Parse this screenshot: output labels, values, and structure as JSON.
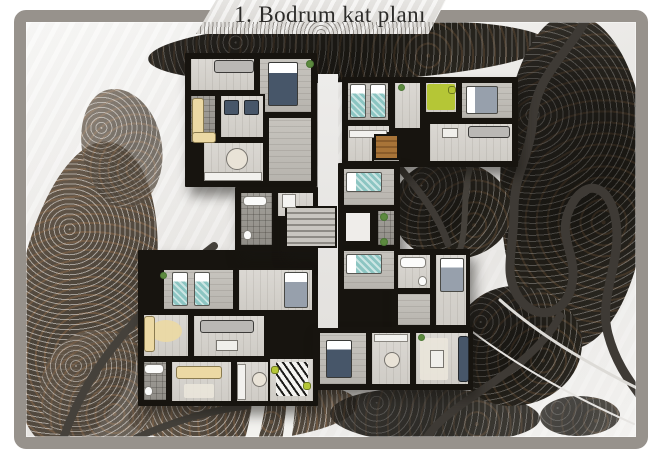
{
  "title": {
    "text": "1. Bodrum kat planı"
  },
  "palette": {
    "frame": "#97928c",
    "wall": "#17140f",
    "floor": "#dbd8d3",
    "floorMid": "#c7c4be",
    "balcony": "#a3a09a",
    "teal": "#8cc5c2",
    "navy": "#475669",
    "cream": "#ecd9a4",
    "lime": "#b5c636",
    "wood": "#8a5c2a",
    "treeDark": "#232019",
    "treeBrown": "#4a4238",
    "road": "#3e3a35",
    "snowPath": "#f3f2ef"
  },
  "scene": {
    "trees": [
      {
        "v": "t-dark",
        "x": 148,
        "y": 20,
        "w": 400,
        "h": 62,
        "r": -2
      },
      {
        "v": "t-dark",
        "x": 500,
        "y": 14,
        "w": 148,
        "h": 336,
        "r": 0
      },
      {
        "v": "t-dark",
        "x": 392,
        "y": 160,
        "w": 120,
        "h": 100,
        "r": 8
      },
      {
        "v": "t-brown",
        "x": 18,
        "y": 140,
        "w": 135,
        "h": 310,
        "r": 10
      },
      {
        "v": "t-brown",
        "x": 82,
        "y": 88,
        "w": 80,
        "h": 120,
        "r": -12,
        "o": 0.75
      },
      {
        "v": "t-brown",
        "x": 128,
        "y": 380,
        "w": 230,
        "h": 62,
        "r": -3
      },
      {
        "v": "t-dark",
        "x": 330,
        "y": 388,
        "w": 210,
        "h": 56,
        "r": 2,
        "o": 0.9
      },
      {
        "v": "t-dark",
        "x": 452,
        "y": 286,
        "w": 130,
        "h": 120,
        "r": 0
      },
      {
        "v": "t-brown",
        "x": 40,
        "y": 330,
        "w": 120,
        "h": 120,
        "r": 0,
        "o": 0.85
      },
      {
        "v": "t-dark",
        "x": 540,
        "y": 396,
        "w": 80,
        "h": 40,
        "r": 0,
        "o": 0.8
      }
    ],
    "roads": [
      {
        "n": "mountain-road",
        "d": "M588,16 C568,54 536,76 533,118 C530,158 514,172 514,210 C514,252 502,272 519,298 C536,322 566,316 572,284 C578,254 556,238 570,208 C584,178 610,182 616,222 C622,262 598,296 608,334 C618,372 638,390 650,410",
        "c": "#3e3a35",
        "w": 9
      },
      {
        "n": "road-branch",
        "d": "M560,316 C538,356 498,378 468,400 C448,414 430,428 422,446",
        "c": "#3e3a35",
        "w": 8
      },
      {
        "n": "road-notch-1",
        "d": "M400,168 C420,192 438,214 448,244",
        "c": "#3e3a35",
        "w": 7
      },
      {
        "n": "road-notch-2",
        "d": "M470,168 C462,198 468,222 460,250",
        "c": "#45413b",
        "w": 6
      },
      {
        "n": "road-left",
        "d": "M214,246 C172,278 122,332 98,368 C82,392 72,414 64,436",
        "c": "#45413b",
        "w": 8
      },
      {
        "n": "road-bottom-left",
        "d": "M136,438 C176,420 214,410 246,406",
        "c": "#45413b",
        "w": 7
      },
      {
        "n": "footpath-1",
        "d": "M259,402 C257,418 254,430 250,446",
        "c": "#f3f2ef",
        "w": 13
      },
      {
        "n": "footpath-2",
        "d": "M291,402 C290,418 288,432 286,446",
        "c": "#f3f2ef",
        "w": 9
      },
      {
        "n": "snow-streak-1",
        "d": "M500,300 C545,340 600,370 645,392",
        "c": "#dddbd7",
        "w": 3
      },
      {
        "n": "snow-streak-2",
        "d": "M470,330 C520,368 580,400 634,424",
        "c": "#e6e4e1",
        "w": 2
      }
    ]
  },
  "plan": {
    "blocks": [
      {
        "x": 185,
        "y": 53,
        "w": 132,
        "h": 134,
        "n": "wing-top-left"
      },
      {
        "x": 342,
        "y": 77,
        "w": 176,
        "h": 90,
        "n": "wing-top-right"
      },
      {
        "x": 338,
        "y": 163,
        "w": 62,
        "h": 166,
        "n": "core-right"
      },
      {
        "x": 392,
        "y": 249,
        "w": 78,
        "h": 82,
        "n": "wing-mid-right"
      },
      {
        "x": 138,
        "y": 250,
        "w": 180,
        "h": 156,
        "n": "wing-bottom-left"
      },
      {
        "x": 313,
        "y": 327,
        "w": 160,
        "h": 63,
        "n": "wing-bottom-right"
      },
      {
        "x": 235,
        "y": 187,
        "w": 83,
        "h": 64,
        "n": "wing-mid-left"
      },
      {
        "x": 281,
        "y": 202,
        "w": 60,
        "h": 50,
        "n": "stair-core"
      }
    ],
    "rooms": [
      {
        "x": 318,
        "y": 74,
        "w": 20,
        "h": 254,
        "f": "snow",
        "n": "light-well"
      },
      {
        "x": 189,
        "y": 57,
        "w": 67,
        "h": 35,
        "f": "light",
        "n": "bedroom"
      },
      {
        "x": 258,
        "y": 57,
        "w": 55,
        "h": 57,
        "f": "mid",
        "n": "bedroom"
      },
      {
        "x": 189,
        "y": 94,
        "w": 28,
        "h": 50,
        "f": "balcony",
        "n": "balcony"
      },
      {
        "x": 219,
        "y": 94,
        "w": 46,
        "h": 45,
        "f": "light",
        "n": "living-room"
      },
      {
        "x": 202,
        "y": 141,
        "w": 63,
        "h": 42,
        "f": "light",
        "n": "kitchen"
      },
      {
        "x": 267,
        "y": 116,
        "w": 46,
        "h": 67,
        "f": "mid",
        "n": "hall"
      },
      {
        "x": 346,
        "y": 81,
        "w": 44,
        "h": 41,
        "f": "mid",
        "n": "bedroom"
      },
      {
        "x": 346,
        "y": 124,
        "w": 45,
        "h": 39,
        "f": "light",
        "n": "study"
      },
      {
        "x": 393,
        "y": 81,
        "w": 29,
        "h": 49,
        "f": "light",
        "n": "hall"
      },
      {
        "x": 424,
        "y": 81,
        "w": 34,
        "h": 33,
        "f": "light",
        "n": "office"
      },
      {
        "x": 460,
        "y": 81,
        "w": 54,
        "h": 39,
        "f": "mid",
        "n": "bedroom"
      },
      {
        "x": 428,
        "y": 122,
        "w": 86,
        "h": 41,
        "f": "light",
        "n": "living-room"
      },
      {
        "x": 372,
        "y": 132,
        "w": 29,
        "h": 31,
        "f": "mid",
        "n": "stair-hall"
      },
      {
        "x": 342,
        "y": 167,
        "w": 54,
        "h": 40,
        "f": "mid",
        "n": "bedroom"
      },
      {
        "x": 342,
        "y": 209,
        "w": 32,
        "h": 36,
        "f": "light",
        "n": "elevator-lobby"
      },
      {
        "x": 376,
        "y": 209,
        "w": 20,
        "h": 38,
        "f": "balcony",
        "n": "lobby"
      },
      {
        "x": 342,
        "y": 249,
        "w": 54,
        "h": 42,
        "f": "mid",
        "n": "bedroom"
      },
      {
        "x": 396,
        "y": 253,
        "w": 36,
        "h": 37,
        "f": "light",
        "n": "bathroom"
      },
      {
        "x": 434,
        "y": 253,
        "w": 34,
        "h": 74,
        "f": "light",
        "n": "bedroom"
      },
      {
        "x": 396,
        "y": 292,
        "w": 36,
        "h": 35,
        "f": "mid",
        "n": "hall"
      },
      {
        "x": 239,
        "y": 191,
        "w": 35,
        "h": 56,
        "f": "balcony",
        "n": "bathroom"
      },
      {
        "x": 276,
        "y": 191,
        "w": 39,
        "h": 27,
        "f": "light",
        "n": "bathroom"
      },
      {
        "x": 162,
        "y": 268,
        "w": 73,
        "h": 43,
        "f": "mid",
        "n": "bedroom"
      },
      {
        "x": 237,
        "y": 268,
        "w": 77,
        "h": 44,
        "f": "light",
        "n": "bedroom"
      },
      {
        "x": 142,
        "y": 313,
        "w": 48,
        "h": 45,
        "f": "light",
        "n": "balcony"
      },
      {
        "x": 192,
        "y": 314,
        "w": 74,
        "h": 44,
        "f": "light",
        "n": "living-room"
      },
      {
        "x": 142,
        "y": 360,
        "w": 26,
        "h": 42,
        "f": "balcony",
        "n": "bathroom"
      },
      {
        "x": 170,
        "y": 360,
        "w": 63,
        "h": 43,
        "f": "light",
        "n": "living-room"
      },
      {
        "x": 235,
        "y": 360,
        "w": 42,
        "h": 43,
        "f": "light",
        "n": "kitchen"
      },
      {
        "x": 268,
        "y": 357,
        "w": 47,
        "h": 46,
        "f": "light",
        "n": "kids-room"
      },
      {
        "x": 318,
        "y": 331,
        "w": 50,
        "h": 55,
        "f": "mid",
        "n": "bedroom"
      },
      {
        "x": 370,
        "y": 331,
        "w": 42,
        "h": 55,
        "f": "light",
        "n": "kitchen"
      },
      {
        "x": 414,
        "y": 331,
        "w": 56,
        "h": 55,
        "f": "light",
        "n": "living-room"
      }
    ],
    "items": [
      {
        "t": "sofa-light",
        "x": 214,
        "y": 60,
        "w": 40,
        "h": 13,
        "n": "sofa"
      },
      {
        "t": "bed-navy",
        "x": 268,
        "y": 62,
        "w": 30,
        "h": 44,
        "n": "bed"
      },
      {
        "t": "armchair-navy",
        "x": 224,
        "y": 100,
        "w": 15,
        "h": 15,
        "n": "armchair"
      },
      {
        "t": "armchair-navy",
        "x": 244,
        "y": 100,
        "w": 15,
        "h": 15,
        "n": "armchair"
      },
      {
        "t": "sofa-cream",
        "x": 192,
        "y": 98,
        "w": 12,
        "h": 40,
        "n": "balcony-sofa"
      },
      {
        "t": "sofa-cream",
        "x": 192,
        "y": 132,
        "w": 24,
        "h": 11,
        "n": "balcony-sofa"
      },
      {
        "t": "table-round",
        "x": 226,
        "y": 148,
        "w": 22,
        "h": 22,
        "n": "dining-table"
      },
      {
        "t": "counter",
        "x": 204,
        "y": 172,
        "w": 58,
        "h": 9,
        "n": "kitchen-counter"
      },
      {
        "t": "plant",
        "x": 306,
        "y": 60,
        "w": 8,
        "h": 8,
        "n": "plant"
      },
      {
        "t": "bed-teal",
        "o": "v",
        "x": 350,
        "y": 84,
        "w": 16,
        "h": 34,
        "n": "bed"
      },
      {
        "t": "bed-teal",
        "o": "v",
        "x": 370,
        "y": 84,
        "w": 16,
        "h": 34,
        "n": "bed"
      },
      {
        "t": "counter",
        "x": 349,
        "y": 130,
        "w": 38,
        "h": 8,
        "n": "desk"
      },
      {
        "t": "rug-green",
        "x": 427,
        "y": 84,
        "w": 28,
        "h": 26,
        "n": "rug"
      },
      {
        "t": "chair-green",
        "x": 448,
        "y": 86,
        "w": 8,
        "h": 8,
        "n": "chair"
      },
      {
        "t": "bed-gray",
        "x": 466,
        "y": 86,
        "w": 32,
        "h": 28,
        "n": "bed"
      },
      {
        "t": "sofa-light",
        "x": 468,
        "y": 126,
        "w": 42,
        "h": 12,
        "n": "sofa"
      },
      {
        "t": "table",
        "x": 442,
        "y": 128,
        "w": 16,
        "h": 10,
        "n": "coffee-table"
      },
      {
        "t": "stair-wood",
        "x": 374,
        "y": 134,
        "w": 25,
        "h": 26,
        "n": "staircase"
      },
      {
        "t": "plant",
        "x": 398,
        "y": 84,
        "w": 7,
        "h": 7,
        "n": "plant"
      },
      {
        "t": "bed-teal",
        "x": 346,
        "y": 172,
        "w": 36,
        "h": 20,
        "n": "bed"
      },
      {
        "t": "elevator",
        "x": 344,
        "y": 211,
        "w": 28,
        "h": 32,
        "n": "elevator"
      },
      {
        "t": "plant",
        "x": 380,
        "y": 213,
        "w": 8,
        "h": 8,
        "n": "plant"
      },
      {
        "t": "plant",
        "x": 380,
        "y": 238,
        "w": 8,
        "h": 8,
        "n": "plant"
      },
      {
        "t": "bed-teal",
        "x": 346,
        "y": 254,
        "w": 36,
        "h": 20,
        "n": "bed"
      },
      {
        "t": "tub",
        "x": 400,
        "y": 257,
        "w": 26,
        "h": 11,
        "n": "bathtub"
      },
      {
        "t": "wc",
        "x": 418,
        "y": 276,
        "w": 9,
        "h": 10,
        "n": "toilet"
      },
      {
        "t": "bed-gray",
        "o": "v",
        "x": 440,
        "y": 258,
        "w": 24,
        "h": 34,
        "n": "bed"
      },
      {
        "t": "stair-gray",
        "x": 285,
        "y": 206,
        "w": 52,
        "h": 42,
        "n": "main-staircase"
      },
      {
        "t": "tub",
        "x": 243,
        "y": 196,
        "w": 24,
        "h": 10,
        "n": "bathtub"
      },
      {
        "t": "wc",
        "x": 243,
        "y": 230,
        "w": 9,
        "h": 10,
        "n": "toilet"
      },
      {
        "t": "shower",
        "x": 282,
        "y": 194,
        "w": 14,
        "h": 14,
        "n": "shower"
      },
      {
        "t": "bed-teal",
        "o": "v",
        "x": 172,
        "y": 272,
        "w": 16,
        "h": 34,
        "n": "bed"
      },
      {
        "t": "bed-teal",
        "o": "v",
        "x": 194,
        "y": 272,
        "w": 16,
        "h": 34,
        "n": "bed"
      },
      {
        "t": "bed-gray",
        "o": "v",
        "x": 284,
        "y": 272,
        "w": 24,
        "h": 36,
        "n": "bed"
      },
      {
        "t": "rug-round",
        "x": 150,
        "y": 320,
        "w": 32,
        "h": 22,
        "n": "rug"
      },
      {
        "t": "sofa-cream",
        "x": 144,
        "y": 316,
        "w": 11,
        "h": 36,
        "n": "balcony-sofa"
      },
      {
        "t": "sofa-light",
        "x": 200,
        "y": 320,
        "w": 54,
        "h": 13,
        "n": "sofa"
      },
      {
        "t": "table",
        "x": 216,
        "y": 340,
        "w": 22,
        "h": 11,
        "n": "coffee-table"
      },
      {
        "t": "tub",
        "x": 144,
        "y": 364,
        "w": 20,
        "h": 10,
        "n": "bathtub"
      },
      {
        "t": "wc",
        "x": 144,
        "y": 386,
        "w": 9,
        "h": 10,
        "n": "toilet"
      },
      {
        "t": "sofa-cream",
        "x": 176,
        "y": 366,
        "w": 46,
        "h": 13,
        "n": "sofa"
      },
      {
        "t": "rug-light",
        "x": 184,
        "y": 384,
        "w": 30,
        "h": 14,
        "n": "rug"
      },
      {
        "t": "counter",
        "x": 237,
        "y": 364,
        "w": 9,
        "h": 36,
        "n": "kitchen-counter"
      },
      {
        "t": "table-round",
        "x": 252,
        "y": 372,
        "w": 15,
        "h": 15,
        "n": "dining-table"
      },
      {
        "t": "rug-zebra",
        "x": 276,
        "y": 362,
        "w": 32,
        "h": 34,
        "n": "zebra-rug"
      },
      {
        "t": "chair-green",
        "x": 271,
        "y": 366,
        "w": 8,
        "h": 8,
        "n": "chair"
      },
      {
        "t": "chair-green",
        "x": 303,
        "y": 382,
        "w": 8,
        "h": 8,
        "n": "chair"
      },
      {
        "t": "plant",
        "x": 160,
        "y": 272,
        "w": 7,
        "h": 7,
        "n": "plant"
      },
      {
        "t": "bed-navy",
        "x": 326,
        "y": 340,
        "w": 26,
        "h": 38,
        "n": "bed"
      },
      {
        "t": "counter",
        "x": 374,
        "y": 334,
        "w": 34,
        "h": 8,
        "n": "kitchen-counter"
      },
      {
        "t": "table-round",
        "x": 384,
        "y": 352,
        "w": 16,
        "h": 16,
        "n": "dining-table"
      },
      {
        "t": "rug-light",
        "x": 420,
        "y": 338,
        "w": 28,
        "h": 42,
        "n": "rug"
      },
      {
        "t": "sofa-navy",
        "x": 458,
        "y": 336,
        "w": 11,
        "h": 46,
        "n": "sofa"
      },
      {
        "t": "table",
        "x": 430,
        "y": 350,
        "w": 14,
        "h": 18,
        "n": "coffee-table"
      },
      {
        "t": "plant",
        "x": 418,
        "y": 334,
        "w": 7,
        "h": 7,
        "n": "plant"
      }
    ]
  }
}
